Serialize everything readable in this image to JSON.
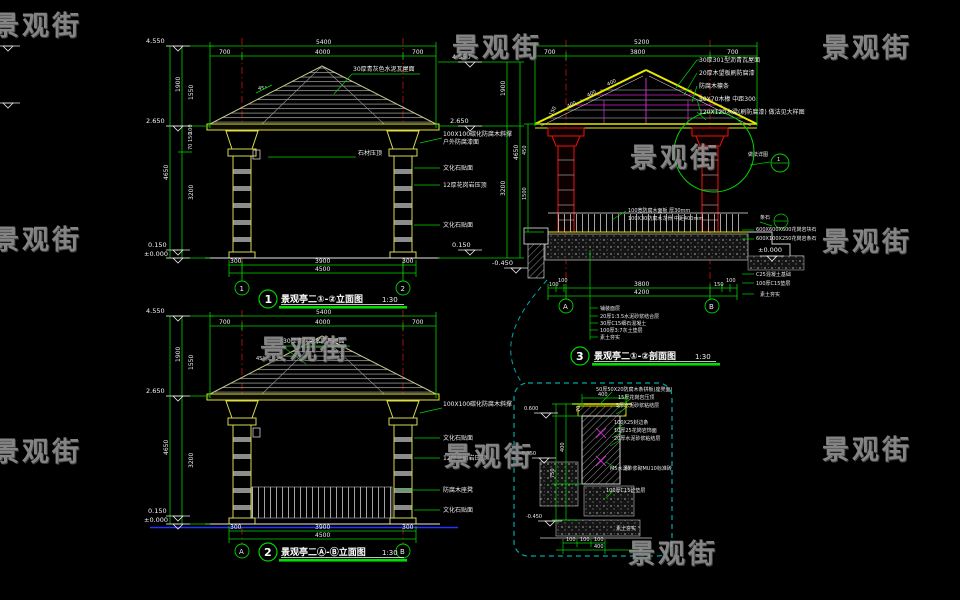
{
  "watermark": {
    "text": "景观街"
  },
  "d1": {
    "no": "1",
    "title": "景观亭二①-②立面图",
    "scale": "1:30",
    "axis": {
      "left": "1",
      "right": "2"
    },
    "top": {
      "total": "5400",
      "l": "700",
      "m": "4000",
      "r": "700"
    },
    "bottom": {
      "l": "300",
      "m": "3900",
      "r": "300",
      "total": "4500"
    },
    "left": {
      "roof": "1900",
      "upper": "1550",
      "t1": "100",
      "t2": "150",
      "t3": "70",
      "col": "4650",
      "shaft": "3200",
      "base": "150"
    },
    "lv": {
      "top": "4.550",
      "eave": "2.650",
      "plinth": "0.150",
      "ground": "±0.000"
    },
    "slope": "45°",
    "roof_note": "30厚青灰色水泥瓦屋面",
    "tag": "石材压顶",
    "notes": [
      "100X100碳化防腐木斜撑",
      "户外防腐漆面",
      "文化石贴面",
      "12厚花岗岩压顶",
      "文化石贴面"
    ]
  },
  "d2": {
    "no": "2",
    "title": "景观亭二Ⓐ-Ⓑ立面图",
    "scale": "1:30",
    "axis": {
      "left": "A",
      "right": "B"
    },
    "top": {
      "total": "5400",
      "l": "700",
      "m": "4000",
      "r": "700"
    },
    "bottom": {
      "l": "300",
      "m": "3900",
      "r": "300",
      "total": "4500"
    },
    "left": {
      "roof": "1900",
      "upper": "1550",
      "col": "4650",
      "shaft": "3200"
    },
    "lv": {
      "top": "4.550",
      "eave": "2.650",
      "plinth": "0.150",
      "ground": "±0.000"
    },
    "slope": "45°",
    "roof_note": "30厚青灰色水泥瓦屋面",
    "notes": [
      "100X100碳化防腐木斜撑",
      "文化石贴面",
      "12厚花岗岩压顶",
      "防腐木座凳",
      "文化石贴面"
    ]
  },
  "d3": {
    "no": "3",
    "title": "景观亭二①-②剖面图",
    "scale": "1:30",
    "axis": {
      "left": "A",
      "right": "B"
    },
    "top": {
      "total": "5200",
      "l": "700",
      "m": "3800",
      "r": "700"
    },
    "bottom": {
      "l1": "100",
      "l2": "100",
      "m": "3800",
      "r1": "150",
      "r2": "100",
      "total": "4200"
    },
    "slope": [
      "400",
      "400",
      "400",
      "150"
    ],
    "leftdims": {
      "a": "450",
      "b": "1500"
    },
    "lv": {
      "ground": "±0.000",
      "foot": "-0.450"
    },
    "roof_notes": [
      "30厚301型沥青瓦屋面",
      "20厚木望板刷防腐漆",
      "防腐木檩条",
      "50X70木椽 中距300",
      "120X120木梁(刷防腐漆) 做法见大样图"
    ],
    "deck_notes": [
      "100宽防腐木面板 厚30mm",
      "100X30防腐木龙骨 中距400mm"
    ],
    "ground_notes": [
      "铺装面层",
      "20厚1:3.5水泥砂浆结合层",
      "30厚C15细石混凝土",
      "100厚3:7灰土垫层",
      "素土夯实"
    ],
    "right_notes": [
      "条石",
      "600X600X600花岗岩块石",
      "600X100X250花岗岩条石",
      "±0.000",
      "C25混凝土基础",
      "100厚C15垫层",
      "素土夯实"
    ],
    "detail_ref": "做法详图",
    "detail_bubble": "1"
  },
  "d4": {
    "lv": {
      "top": "0.600",
      "mid": "-0.150",
      "bottom": "-0.450"
    },
    "dims": {
      "top": "400",
      "side": "400",
      "s2": "750",
      "b1": "100",
      "b2": "100",
      "b3": "100",
      "total": "400",
      "w": "70",
      "h": "30"
    },
    "notes": [
      "50厚50X20防腐木条拼板(座凳面)",
      "15厚花岗岩压顶",
      "5厚水泥砂浆粘结层",
      "100X25封边条",
      "10厚25花岗岩饰面",
      "20厚水泥砂浆粘结层",
      "M5水泥砂浆砌MU10标准砖",
      "100厚C15砼垫层",
      "素土夯实"
    ]
  }
}
